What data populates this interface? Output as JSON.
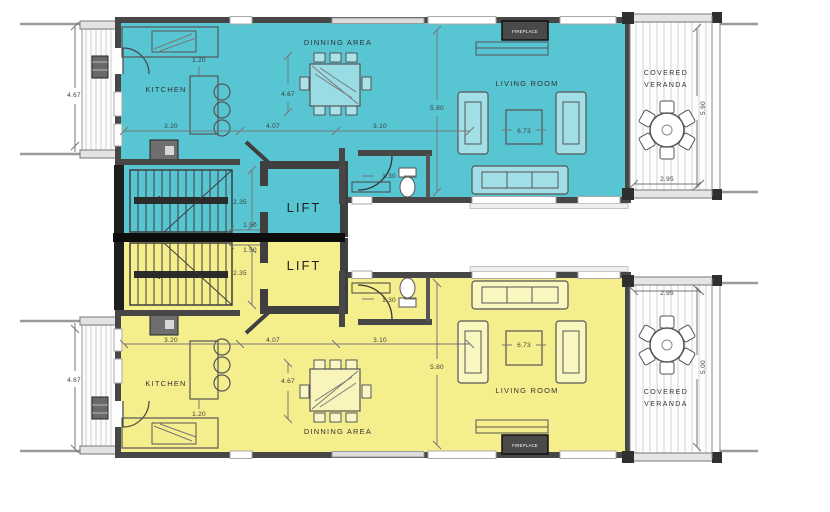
{
  "colors": {
    "upper_unit_fill": "#58c5d3",
    "lower_unit_fill": "#f5ee8c",
    "wall": "#474747",
    "lift_wall": "#3f3f3f",
    "divider": "#0d0d0d",
    "veranda_stripe": "#d2d2d2"
  },
  "upper": {
    "labels": {
      "kitchen": "KITCHEN",
      "dining": "DINNING AREA",
      "living": "LIVING ROOM",
      "lift": "LIFT",
      "fireplace": "FIREPLACE",
      "veranda_line1": "COVERED",
      "veranda_line2": "VERANDA"
    },
    "dims": {
      "balcony_height": "4.67",
      "kitchen_opening": "1.20",
      "kitchen_width": "3.20",
      "dining_width": "4.07",
      "dining_height": "4.67",
      "hall_width": "3.10",
      "living_height": "5.80",
      "coffee_table": "6.73",
      "wc_width": "1.30",
      "stair_width": "2.35",
      "landing": "1.50",
      "veranda_width": "2.95",
      "veranda_height": "5.90"
    }
  },
  "lower": {
    "labels": {
      "kitchen": "KITCHEN",
      "dining": "DINNING AREA",
      "living": "LIVING ROOM",
      "lift": "LIFT",
      "fireplace": "FIREPLACE",
      "veranda_line1": "COVERED",
      "veranda_line2": "VERANDA"
    },
    "dims": {
      "balcony_height": "4.67",
      "kitchen_opening": "1.20",
      "kitchen_width": "3.20",
      "dining_width": "4.07",
      "dining_height": "4.67",
      "hall_width": "3.10",
      "living_height": "5.80",
      "coffee_table": "6.73",
      "wc_width": "1.30",
      "stair_width": "2.35",
      "landing": "1.50",
      "veranda_width": "2.95",
      "veranda_height": "5.00"
    }
  }
}
